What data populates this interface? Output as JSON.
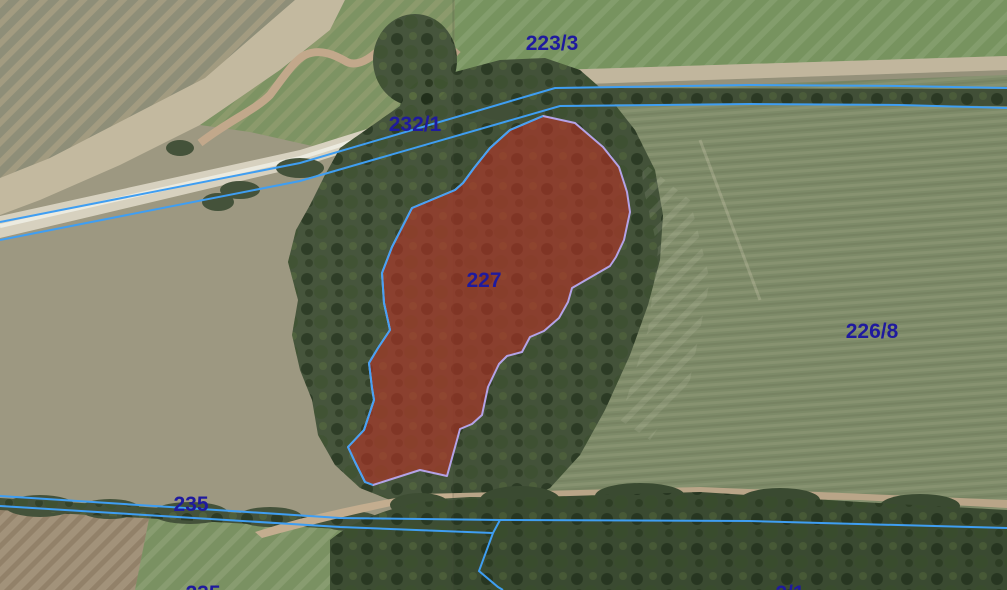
{
  "map": {
    "type": "cadastral-orthophoto",
    "highlighted_parcel": "227"
  },
  "labels": [
    {
      "parcel": "223/3",
      "text": "223/3"
    },
    {
      "parcel": "232/1",
      "text": "232/1"
    },
    {
      "parcel": "227",
      "text": "227"
    },
    {
      "parcel": "226/8",
      "text": "226/8"
    },
    {
      "parcel": "235",
      "text": "235"
    },
    {
      "parcel": "235-bottom",
      "text": "235"
    },
    {
      "parcel": "2/1",
      "text": "2/1"
    }
  ],
  "colors": {
    "boundary_line": "#3f9ef2",
    "parcel_fill": "rgba(190,50,38,0.58)",
    "parcel_stroke": "#b4a3e6",
    "parcel_edge_blue": "#47a1f3",
    "label_text": "#1f1a9e"
  }
}
